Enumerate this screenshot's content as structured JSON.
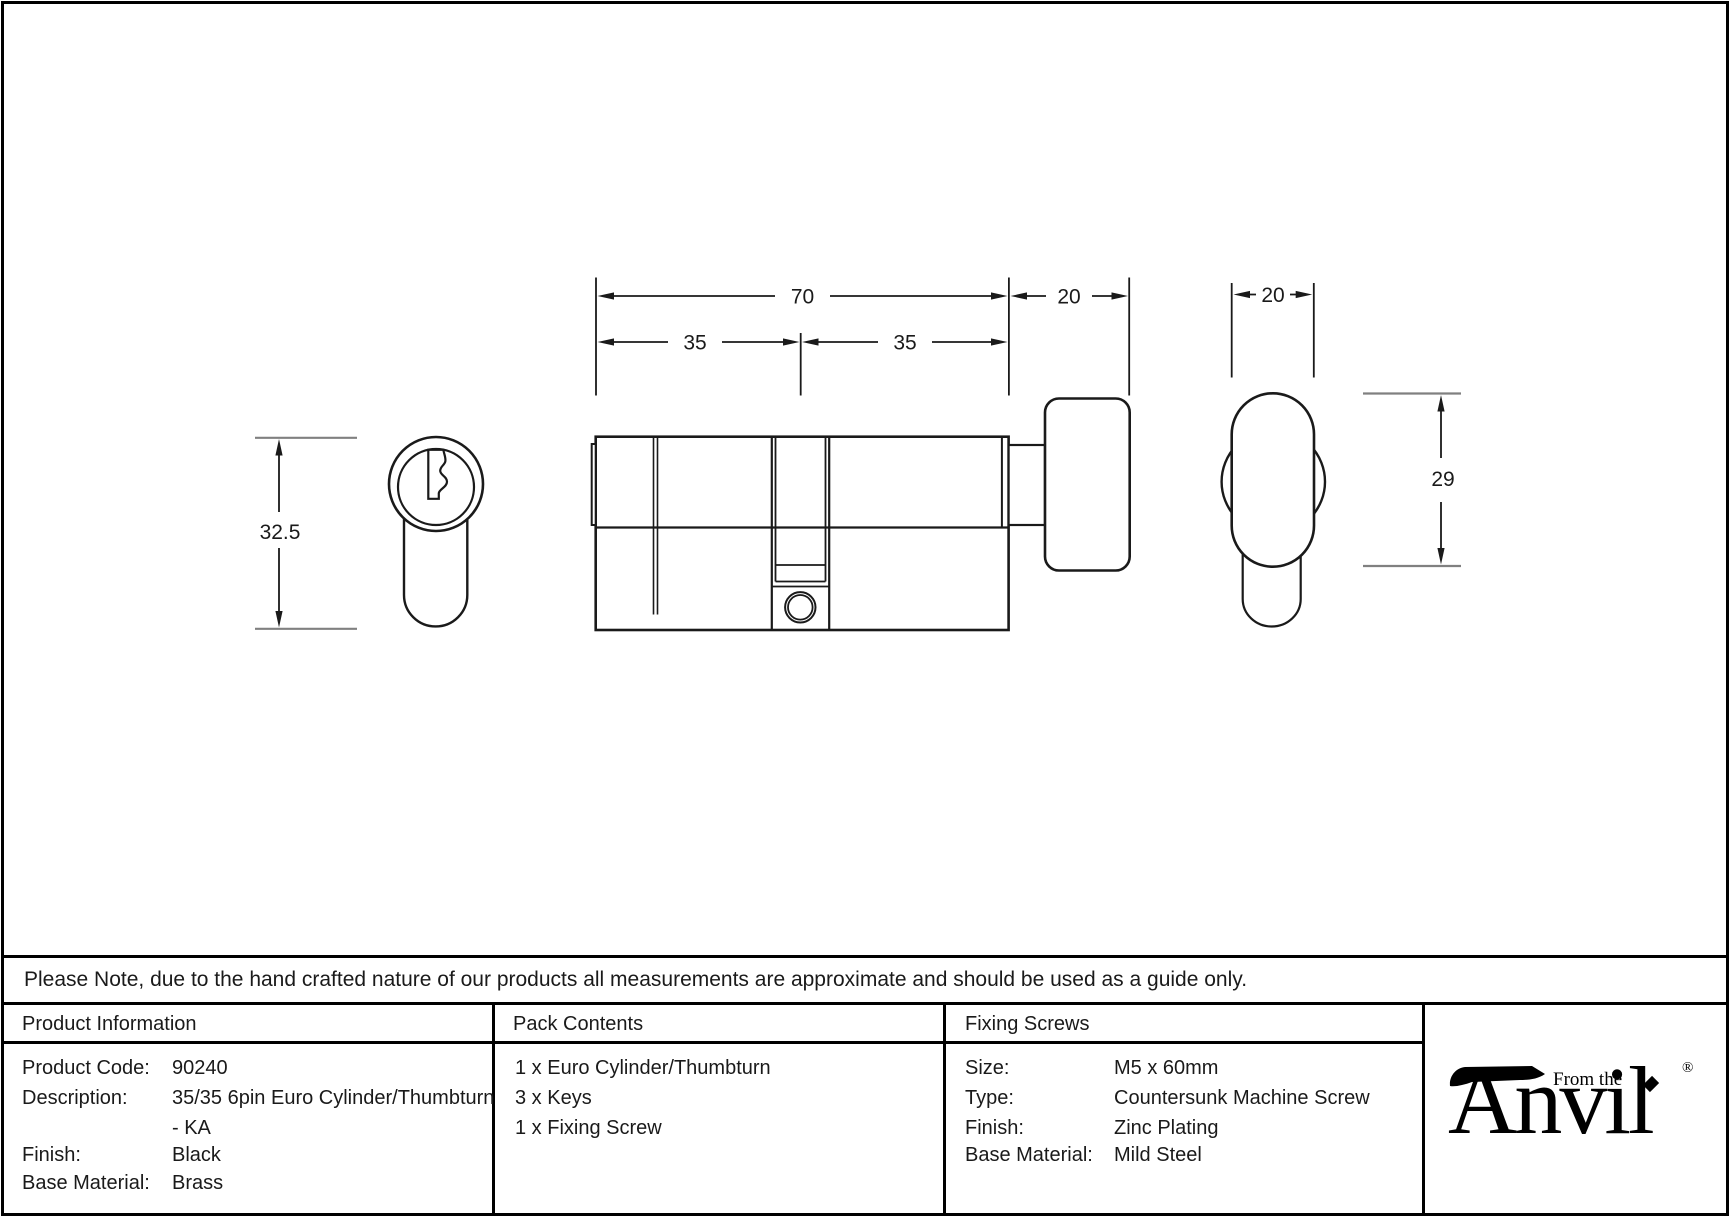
{
  "drawing": {
    "dim_overall_length": "70",
    "dim_left_half": "35",
    "dim_right_half": "35",
    "dim_thumbturn_length": "20",
    "dim_knob_width": "20",
    "dim_body_height": "32.5",
    "dim_knob_height": "29"
  },
  "note": {
    "text": "Please Note, due to the hand crafted nature of our products all measurements are approximate and should be used as a guide only."
  },
  "table": {
    "product_information": {
      "header": "Product Information",
      "rows": [
        {
          "label": "Product Code:",
          "value": "90240"
        },
        {
          "label": "Description:",
          "value": "35/35 6pin Euro Cylinder/Thumbturn"
        },
        {
          "label": "",
          "value": "- KA"
        },
        {
          "label": "Finish:",
          "value": "Black"
        },
        {
          "label": "Base Material:",
          "value": "Brass"
        }
      ]
    },
    "pack_contents": {
      "header": "Pack Contents",
      "items": [
        "1 x Euro Cylinder/Thumbturn",
        "3 x Keys",
        "1 x Fixing Screw"
      ]
    },
    "fixing_screws": {
      "header": "Fixing Screws",
      "rows": [
        {
          "label": "Size:",
          "value": "M5 x 60mm"
        },
        {
          "label": "Type:",
          "value": "Countersunk Machine Screw"
        },
        {
          "label": "Finish:",
          "value": "Zinc Plating"
        },
        {
          "label": "Base Material:",
          "value": "Mild Steel"
        }
      ]
    }
  },
  "logo": {
    "tagline": "From the",
    "brand": "Anvil",
    "registered": "®"
  },
  "colors": {
    "line": "#1a1a1a",
    "extension_gray": "#808080",
    "border": "#000000",
    "background": "#ffffff"
  }
}
